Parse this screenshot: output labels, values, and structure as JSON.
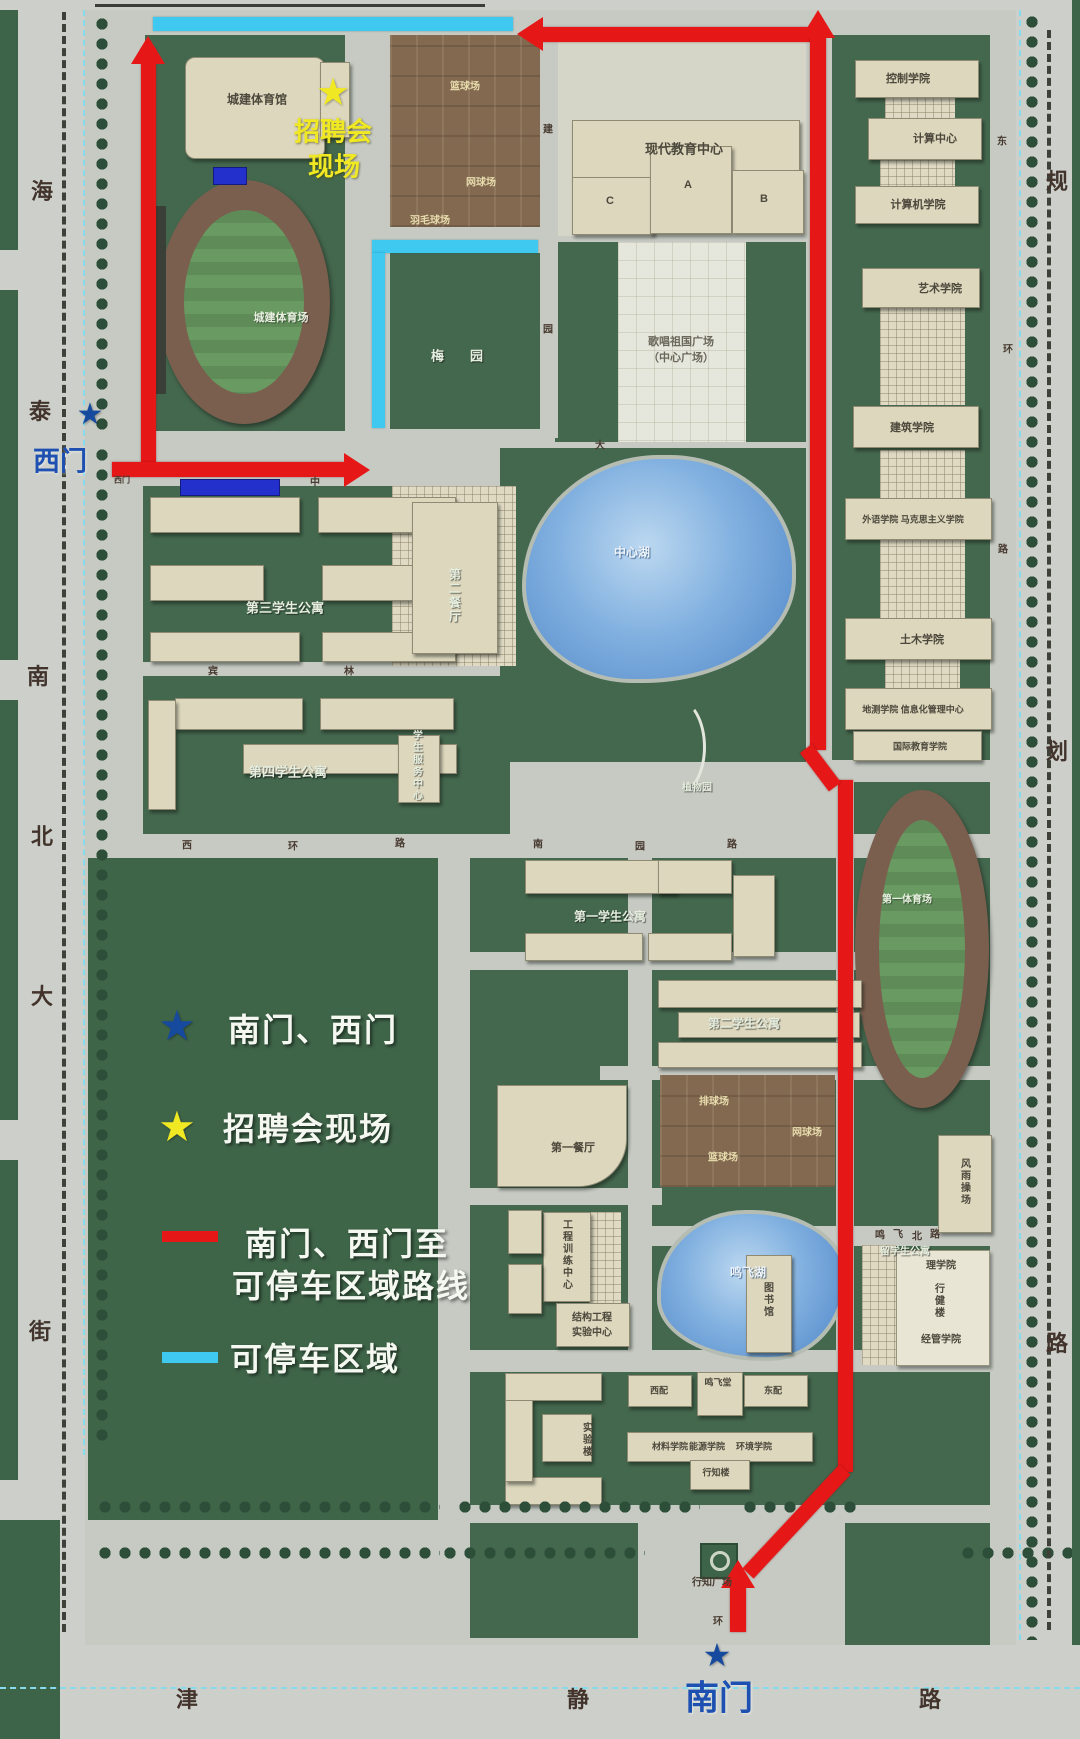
{
  "legend": {
    "gate_star_label": "南门、西门",
    "venue_star_label": "招聘会现场",
    "route_label_line1": "南门、西门至",
    "route_label_line2": "可停车区域路线",
    "parking_label": "可停车区域"
  },
  "gates": {
    "west": "西门",
    "south": "南门"
  },
  "venue": {
    "line1": "招聘会",
    "line2": "现场"
  },
  "colors": {
    "route": "#e61717",
    "parking": "#3fc8f0",
    "gate_star": "#164a9e",
    "gate_text": "#1d50b0",
    "venue_star": "#f0e822",
    "venue_text": "#f0e822",
    "legend_text": "#f4f8f0"
  },
  "streets": [
    {
      "t": "海",
      "x": 42,
      "y": 190
    },
    {
      "t": "泰",
      "x": 40,
      "y": 410
    },
    {
      "t": "南",
      "x": 38,
      "y": 675
    },
    {
      "t": "北",
      "x": 42,
      "y": 835
    },
    {
      "t": "大",
      "x": 42,
      "y": 995
    },
    {
      "t": "街",
      "x": 40,
      "y": 1330
    },
    {
      "t": "规",
      "x": 1057,
      "y": 180
    },
    {
      "t": "划",
      "x": 1057,
      "y": 750
    },
    {
      "t": "路",
      "x": 1057,
      "y": 1342
    },
    {
      "t": "津",
      "x": 187,
      "y": 1698
    },
    {
      "t": "静",
      "x": 578,
      "y": 1698
    },
    {
      "t": "路",
      "x": 930,
      "y": 1698
    }
  ],
  "road_chars": [
    {
      "t": "建",
      "x": 548,
      "y": 128
    },
    {
      "t": "园",
      "x": 548,
      "y": 328
    },
    {
      "t": "中",
      "x": 315,
      "y": 481
    },
    {
      "t": "大",
      "x": 600,
      "y": 444
    },
    {
      "t": "宾",
      "x": 213,
      "y": 670
    },
    {
      "t": "林",
      "x": 349,
      "y": 670
    },
    {
      "t": "西",
      "x": 187,
      "y": 844
    },
    {
      "t": "环",
      "x": 293,
      "y": 845
    },
    {
      "t": "路",
      "x": 400,
      "y": 842
    },
    {
      "t": "南",
      "x": 538,
      "y": 843
    },
    {
      "t": "园",
      "x": 640,
      "y": 845
    },
    {
      "t": "路",
      "x": 732,
      "y": 843
    },
    {
      "t": "东",
      "x": 1002,
      "y": 140
    },
    {
      "t": "环",
      "x": 1008,
      "y": 348
    },
    {
      "t": "路",
      "x": 1003,
      "y": 548
    },
    {
      "t": "鸣",
      "x": 880,
      "y": 1234
    },
    {
      "t": "飞",
      "x": 898,
      "y": 1233
    },
    {
      "t": "北",
      "x": 917,
      "y": 1235
    },
    {
      "t": "路",
      "x": 935,
      "y": 1233
    },
    {
      "t": "环",
      "x": 718,
      "y": 1620
    },
    {
      "t": "西门",
      "x": 122,
      "y": 480,
      "fs": 8
    },
    {
      "t": "行知广场",
      "x": 712,
      "y": 1581
    }
  ],
  "places": [
    {
      "t": "城建体育馆",
      "x": 257,
      "y": 99,
      "c": "lb",
      "fs": 12
    },
    {
      "t": "篮球场",
      "x": 465,
      "y": 85,
      "c": "ct"
    },
    {
      "t": "网球场",
      "x": 481,
      "y": 181,
      "c": "ct"
    },
    {
      "t": "羽毛球场",
      "x": 430,
      "y": 219,
      "c": "ct"
    },
    {
      "t": "梅园",
      "x": 470,
      "y": 355,
      "c": "lg",
      "ls": 26,
      "fs": 13
    },
    {
      "t": "现代教育中心",
      "x": 684,
      "y": 148,
      "c": "lb",
      "fs": 13
    },
    {
      "t": "A",
      "x": 688,
      "y": 185,
      "c": "lb"
    },
    {
      "t": "C",
      "x": 610,
      "y": 201,
      "c": "lb"
    },
    {
      "t": "B",
      "x": 764,
      "y": 199,
      "c": "lb"
    },
    {
      "t": "歌唱祖国广场",
      "x": 681,
      "y": 341,
      "c": "pz"
    },
    {
      "t": "（中心广场）",
      "x": 681,
      "y": 357,
      "c": "pz"
    },
    {
      "t": "城建体育场",
      "x": 281,
      "y": 317,
      "c": "fd"
    },
    {
      "t": "控制学院",
      "x": 908,
      "y": 78,
      "c": "lb"
    },
    {
      "t": "计算中心",
      "x": 935,
      "y": 138,
      "c": "lb"
    },
    {
      "t": "计算机学院",
      "x": 918,
      "y": 204,
      "c": "lb"
    },
    {
      "t": "艺术学院",
      "x": 940,
      "y": 288,
      "c": "lb"
    },
    {
      "t": "建筑学院",
      "x": 912,
      "y": 427,
      "c": "lb"
    },
    {
      "t": "外语学院 马克思主义学院",
      "x": 913,
      "y": 519,
      "c": "lb",
      "fs": 9
    },
    {
      "t": "土木学院",
      "x": 922,
      "y": 639,
      "c": "lb"
    },
    {
      "t": "地测学院 信息化管理中心",
      "x": 913,
      "y": 709,
      "c": "lb",
      "fs": 9
    },
    {
      "t": "国际教育学院",
      "x": 920,
      "y": 746,
      "c": "lb",
      "fs": 9
    },
    {
      "t": "中心湖",
      "x": 632,
      "y": 552,
      "c": "lk"
    },
    {
      "t": "第三学生公寓",
      "x": 285,
      "y": 607,
      "c": "lg"
    },
    {
      "t": "第二餐厅",
      "x": 455,
      "y": 596,
      "c": "lg",
      "v": 1,
      "fs": 12
    },
    {
      "t": "第四学生公寓",
      "x": 288,
      "y": 771,
      "c": "lg"
    },
    {
      "t": "学生服务中心",
      "x": 416,
      "y": 766,
      "c": "lg",
      "v": 1,
      "fs": 10
    },
    {
      "t": "植物园",
      "x": 697,
      "y": 786,
      "c": "lg",
      "fs": 10
    },
    {
      "t": "第一学生公寓",
      "x": 610,
      "y": 916,
      "c": "lg",
      "fs": 12
    },
    {
      "t": "第二学生公寓",
      "x": 744,
      "y": 1023,
      "c": "lg",
      "fs": 12
    },
    {
      "t": "第一体育场",
      "x": 907,
      "y": 898,
      "c": "fd",
      "fs": 10
    },
    {
      "t": "排球场",
      "x": 714,
      "y": 1100,
      "c": "ct"
    },
    {
      "t": "网球场",
      "x": 807,
      "y": 1131,
      "c": "ct"
    },
    {
      "t": "篮球场",
      "x": 723,
      "y": 1156,
      "c": "ct"
    },
    {
      "t": "第一餐厅",
      "x": 573,
      "y": 1147,
      "c": "lb"
    },
    {
      "t": "风雨操场",
      "x": 964,
      "y": 1182,
      "c": "lb",
      "v": 1,
      "fs": 10
    },
    {
      "t": "工程训练中心",
      "x": 566,
      "y": 1255,
      "c": "lb",
      "v": 1,
      "fs": 10
    },
    {
      "t": "结构工程",
      "x": 592,
      "y": 1316,
      "c": "lb",
      "fs": 10
    },
    {
      "t": "实验中心",
      "x": 592,
      "y": 1331,
      "c": "lb",
      "fs": 10
    },
    {
      "t": "鸣飞湖",
      "x": 748,
      "y": 1272,
      "c": "lk"
    },
    {
      "t": "留学生公寓",
      "x": 905,
      "y": 1250,
      "c": "lg",
      "fs": 10
    },
    {
      "t": "理学院",
      "x": 941,
      "y": 1264,
      "c": "lb",
      "fs": 10
    },
    {
      "t": "行健楼",
      "x": 938,
      "y": 1301,
      "c": "lb",
      "v": 1,
      "fs": 10
    },
    {
      "t": "经管学院",
      "x": 941,
      "y": 1338,
      "c": "lb",
      "fs": 10
    },
    {
      "t": "图书馆",
      "x": 767,
      "y": 1300,
      "c": "lb",
      "v": 1,
      "fs": 10
    },
    {
      "t": "实验楼",
      "x": 586,
      "y": 1440,
      "c": "lb",
      "v": 1,
      "fs": 10
    },
    {
      "t": "西配",
      "x": 659,
      "y": 1390,
      "c": "lb",
      "fs": 9
    },
    {
      "t": "鸣飞堂",
      "x": 718,
      "y": 1382,
      "c": "lb",
      "fs": 9
    },
    {
      "t": "东配",
      "x": 773,
      "y": 1390,
      "c": "lb",
      "fs": 9
    },
    {
      "t": "材料学院",
      "x": 670,
      "y": 1446,
      "c": "lb",
      "fs": 9
    },
    {
      "t": "能源学院",
      "x": 707,
      "y": 1446,
      "c": "lb",
      "fs": 9
    },
    {
      "t": "环境学院",
      "x": 754,
      "y": 1446,
      "c": "lb",
      "fs": 9
    },
    {
      "t": "行知楼",
      "x": 716,
      "y": 1472,
      "c": "lb",
      "fs": 9
    }
  ]
}
